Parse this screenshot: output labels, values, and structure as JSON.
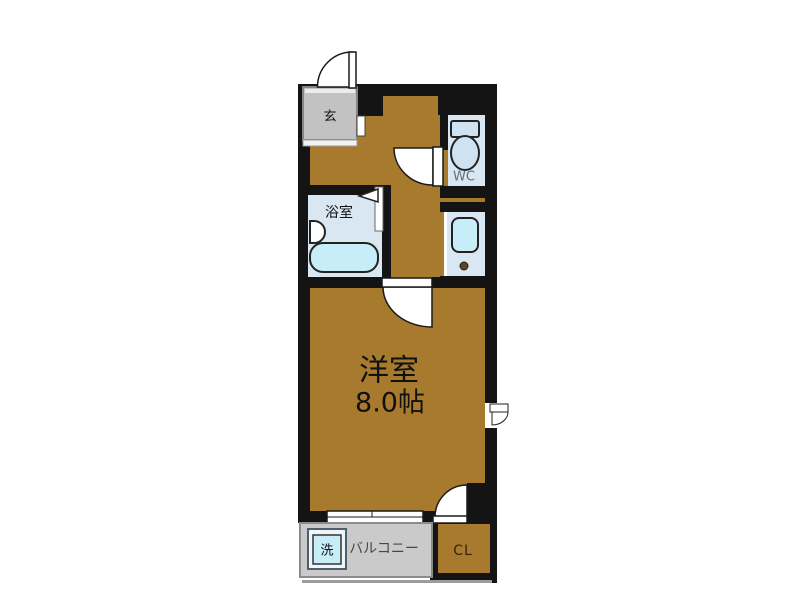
{
  "plan": {
    "rooms": {
      "genkan": {
        "label": "玄"
      },
      "toilet": {
        "label": "WC"
      },
      "bathroom": {
        "label": "浴室"
      },
      "main_room": {
        "label": "洋室",
        "area": "8.0帖"
      },
      "balcony": {
        "label": "バルコニー"
      },
      "washer": {
        "label": "洗"
      },
      "closet": {
        "label": "CL"
      }
    },
    "colors": {
      "wall": "#141414",
      "floor": "#a87a2d",
      "wet_room": "#d9e7f3",
      "fixture": "#cfe2f2",
      "tub": "#c6edf8",
      "balcony": "#cacaca",
      "genkan": "#c2c2c2"
    }
  }
}
